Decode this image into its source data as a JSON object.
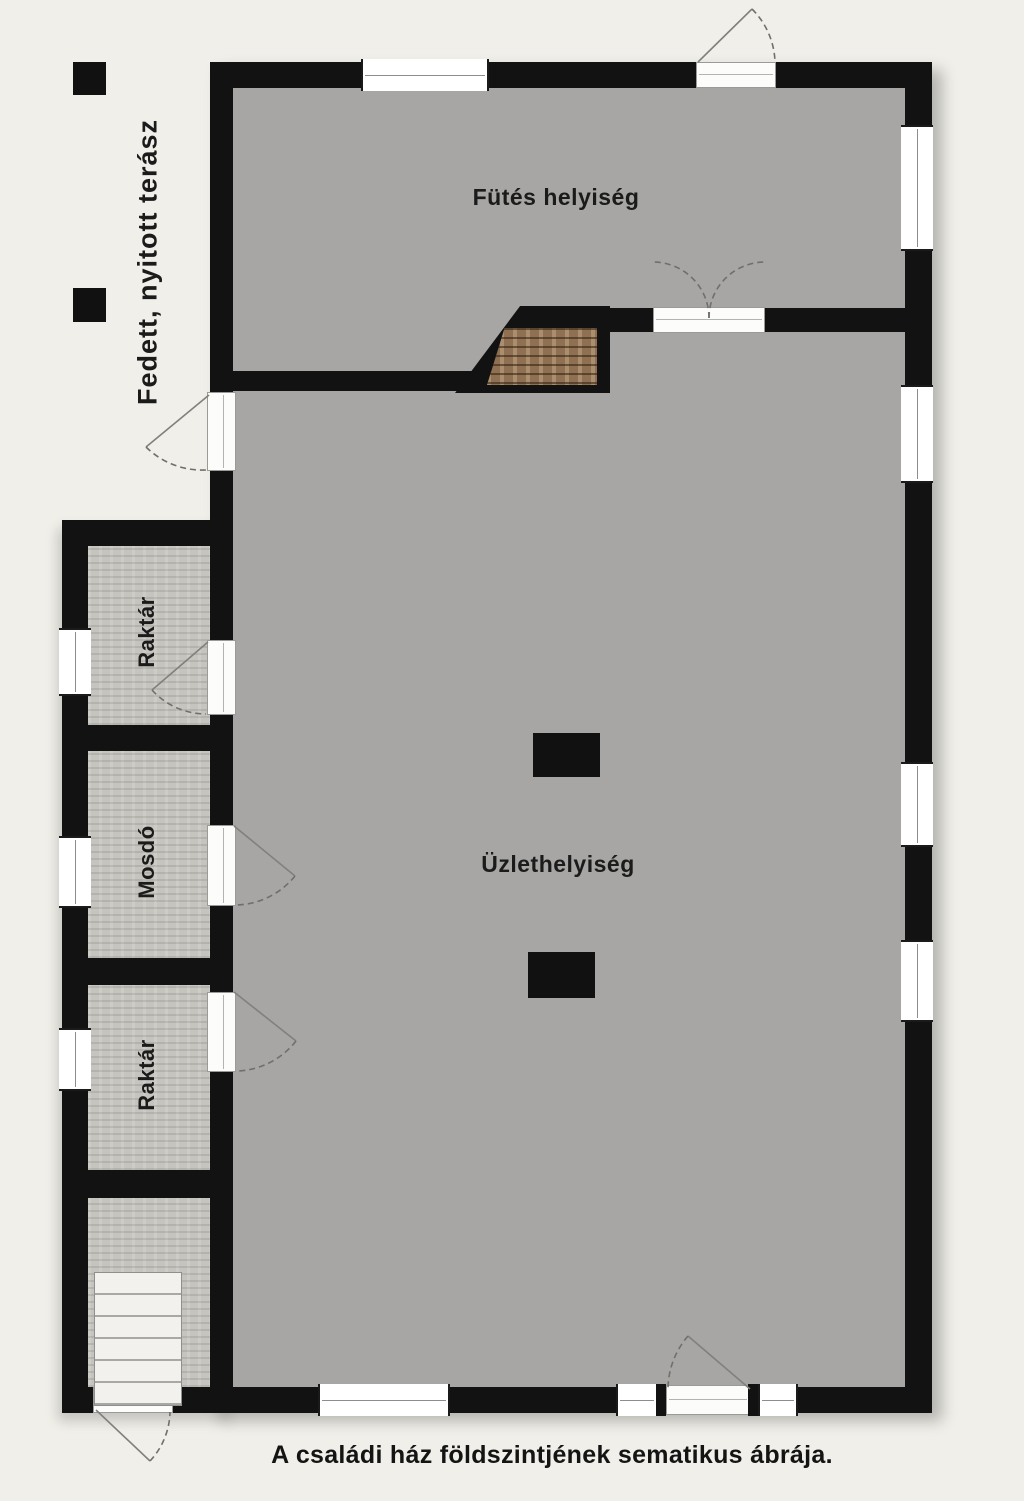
{
  "meta": {
    "caption": "A családi ház földszintjének sematikus ábrája."
  },
  "rooms": {
    "heating": {
      "label": "Fütés helyiség"
    },
    "shop": {
      "label": "Üzlethelyiség"
    },
    "storage_upper": {
      "label": "Raktár"
    },
    "washroom": {
      "label": "Mosdó"
    },
    "storage_lower": {
      "label": "Raktár"
    },
    "terrace": {
      "label": "Fedett, nyitott terász"
    }
  },
  "colors": {
    "background": "#f1efe9",
    "wall": "#121212",
    "room_fill": "#a7a6a4",
    "annex_fill": "#c6c4be",
    "stair_wood": "#8f7053",
    "stair_light": "#f2f1ee",
    "window_glass": "#ffffff"
  }
}
